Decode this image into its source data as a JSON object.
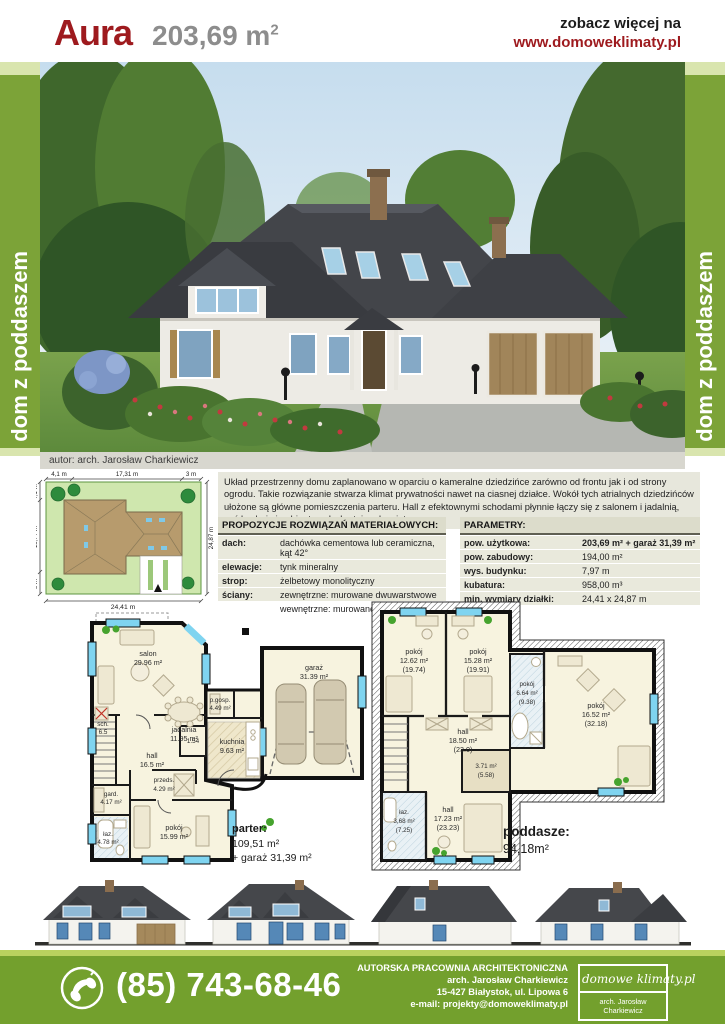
{
  "header": {
    "title": "Aura",
    "area": "203,69 m",
    "area_sup": "2",
    "see_more": "zobacz więcej na",
    "site": "www.domoweklimaty.pl"
  },
  "banner": {
    "text": "dom z poddaszem"
  },
  "photo": {
    "caption": "autor:  arch. Jarosław Charkiewicz"
  },
  "site_plan": {
    "top": [
      "4,1 m",
      "17,31 m",
      "3 m"
    ],
    "left": [
      "4,1 m",
      "15,77 m",
      "5 m"
    ],
    "right": "24,87 m",
    "bottom": "24,41 m"
  },
  "description": "Układ przestrzenny domu zaplanowano w oparciu o kameralne dziedzińce zarówno od frontu jak i od strony ogrodu. Takie rozwiązanie stwarza klimat prywatności nawet na ciasnej działce. Wokół tych atrialnych dziedzińców ułożone są główne pomieszczenia parteru. Hall z efektownymi schodami płynnie łączy się z salonem i jadalnią, zaś kuchnia i gabinet są dyskretnie odsunięte.",
  "materials": {
    "title": "PROPOZYCJE ROZWIĄZAŃ MATERIAŁOWYCH:",
    "rows": [
      {
        "label": "dach:",
        "value": "dachówka cementowa lub ceramiczna, kąt 42°"
      },
      {
        "label": "elewacje:",
        "value": "tynk mineralny"
      },
      {
        "label": "strop:",
        "value": "żelbetowy monolityczny"
      },
      {
        "label": "ściany:",
        "value": "zewnętrzne: murowane dwuwarstwowe"
      },
      {
        "label": "",
        "value": "wewnętrzne: murowane"
      }
    ]
  },
  "parameters": {
    "title": "PARAMETRY:",
    "rows": [
      {
        "label": "pow. użytkowa:",
        "value": "203,69 m² + garaż 31,39 m²"
      },
      {
        "label": "pow. zabudowy:",
        "value": "194,00 m²"
      },
      {
        "label": "wys. budynku:",
        "value": "7,97 m"
      },
      {
        "label": "kubatura:",
        "value": "958,00 m³"
      },
      {
        "label": "min. wymiary działki:",
        "value": "24,41 x 24,87 m"
      }
    ]
  },
  "parter": {
    "rooms": {
      "salon": {
        "name": "salon",
        "area": "29.96 m²"
      },
      "jadalnia": {
        "name": "jadalnia",
        "area": "11.95 m²"
      },
      "hall": {
        "name": "hall",
        "area": "16.5 m²"
      },
      "kuchnia": {
        "name": "kuchnia",
        "area": "9.63 m²"
      },
      "pgosp": {
        "name": "p.gosp.",
        "area": "4.49 m²"
      },
      "garaz": {
        "name": "garaż",
        "area": "31.39 m²"
      },
      "wc": {
        "area": "1.54"
      },
      "sch": {
        "name": "sch.",
        "area": "6.5"
      },
      "gard": {
        "name": "gard.",
        "area": "4.17 m²"
      },
      "przeds": {
        "name": "przeds.",
        "area": "4.29 m²"
      },
      "pokoj": {
        "name": "pokój",
        "area": "15.99 m²"
      },
      "laz": {
        "name": "łaz.",
        "area": "4.78 m²"
      }
    },
    "caption": {
      "title": "parter:",
      "line1": "109,51 m²",
      "line2": "+ garaż 31,39 m²"
    }
  },
  "poddasze": {
    "rooms": {
      "pokoj1": {
        "name": "pokój",
        "area": "12.62 m²",
        "gross": "(19.74)"
      },
      "pokoj2": {
        "name": "pokój",
        "area": "15.28 m²",
        "gross": "(19.91)"
      },
      "pokoj3": {
        "name": "pokój",
        "area": "6.64 m²",
        "gross": "(9.38)"
      },
      "pokoj4": {
        "name": "pokój",
        "area": "16.52 m²",
        "gross": "(32.18)"
      },
      "hall": {
        "name": "hall",
        "area": "18.50 m²",
        "gross": "(23.0)"
      },
      "gard": {
        "area": "3.71 m²",
        "gross": "(5.58)"
      },
      "hall2": {
        "name": "hall",
        "area": "17.23 m²",
        "gross": "(23.23)"
      },
      "laz": {
        "name": "łaz.",
        "area": "3,68 m²",
        "gross": "(7.25)"
      }
    },
    "caption": {
      "title": "poddasze:",
      "line1": "94,18m²"
    }
  },
  "footer": {
    "phone": "(85) 743-68-46",
    "studio_lines": [
      "AUTORSKA PRACOWNIA ARCHITEKTONICZNA",
      "arch. Jarosław Charkiewicz",
      "15-427 Białystok, ul. Lipowa 6",
      "e-mail: projekty@domoweklimaty.pl"
    ],
    "logo_title": "domowe klimaty.pl",
    "logo_sub": "arch. Jarosław Charkiewicz"
  },
  "colors": {
    "accent_red": "#9e1a1e",
    "bar_green": "#7ca338",
    "footer_green": "#73a02d"
  }
}
